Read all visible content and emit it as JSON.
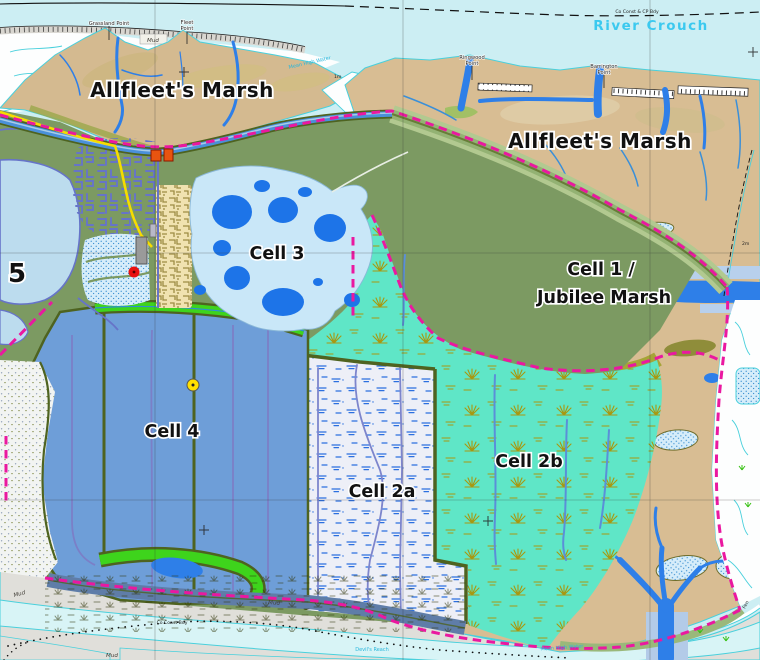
{
  "map": {
    "title": "Wallasea Island managed realignment cells map",
    "labels": {
      "allfleets_marsh_west": "Allfleet's Marsh",
      "allfleets_marsh_east": "Allfleet's Marsh",
      "cell1_line1": "Cell 1 /",
      "cell1_line2": "Jubilee Marsh",
      "cell2a": "Cell 2a",
      "cell2b": "Cell 2b",
      "cell3": "Cell 3",
      "cell4": "Cell 4",
      "cell5_partial": "5",
      "river_crouch": "River Crouch",
      "grassland_point": "Grassland Point",
      "fleet_point_line1": "Fleet",
      "fleet_point_line2": "Point",
      "ringwood_point_line1": "Ringwood",
      "ringwood_point_line2": "Point",
      "barrington_point_line1": "Barrington",
      "barrington_point_line2": "Point",
      "co_const_cp_bdy": "Co Const & CP Bdy",
      "co_const_bdy": "Co Const Bdy",
      "mud_coast": "Mud",
      "mud_sw": "Mud",
      "mud_s1": "Mud",
      "mud_s2": "Mud",
      "mean_high_water_nw": "Mean High Water",
      "mean_high_water_se": "Mean High Water",
      "devils_reach": "Devil's Reach",
      "fen": "Fen",
      "contour_1m": "1m",
      "contour_2m": "2m"
    },
    "markers": {
      "building_marker": "grey-building",
      "red_dot_marker": "red-circle-point",
      "yellow_dot_marker": "yellow-circle-point",
      "orange_buildings": "two-orange-squares"
    },
    "colors": {
      "sea": "#cceef3",
      "mud_gray": "#e0dfda",
      "water_pale": "#d8f4f6",
      "tan_marsh": "#d8bd93",
      "green_field": "#7c9a62",
      "slope_green": "#a8c084",
      "olive_dark": "#6f6d2a",
      "olive_light": "#a6a438",
      "turquoise_cell2b": "#5fe6c7",
      "cell4_blue": "#6e9ed8",
      "lake_blue": "#bcdcee",
      "cell3_blue": "#c9e7f8",
      "pond_blue": "#1d74e8",
      "creek_blue": "#2e7fe8",
      "channel_purple": "#7b7fc7",
      "bright_green": "#3ed41c",
      "boundary_magenta": "#ea18a0",
      "road_yellow": "#f6dc00",
      "seawall_olive": "#4e6320",
      "marsh2a_bg": "#edeff7",
      "marsh2a_symbol": "#2b6fe0",
      "tuft_olive": "#a89810",
      "slate_band": "#5f7da8",
      "coast_cyan": "#49d0dc",
      "label_cyan": "#3bc9ef"
    }
  }
}
